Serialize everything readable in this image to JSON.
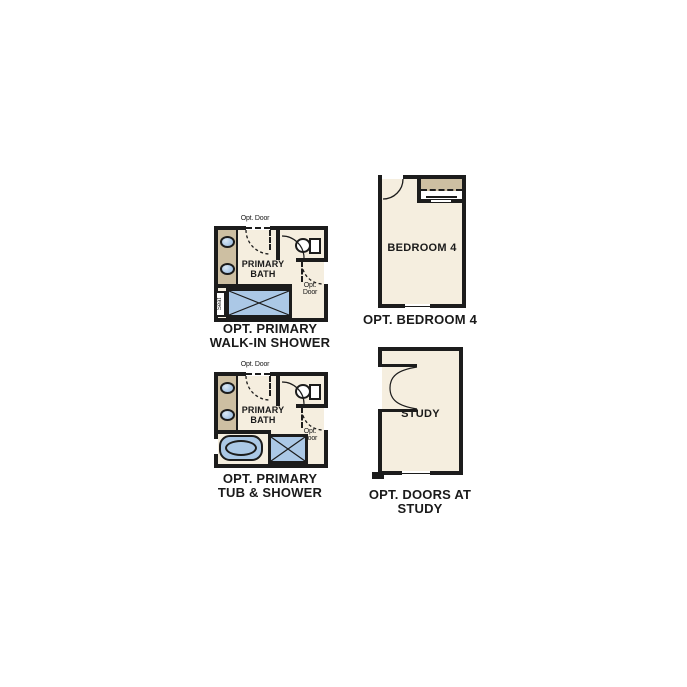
{
  "palette": {
    "wall": "#1c1c1c",
    "floor": "#f5eedf",
    "cabinet_tan": "#cdbfa2",
    "fixture_blue": "#abc8e6",
    "fixture_white": "#ffffff"
  },
  "plans": {
    "walk_in_shower": {
      "opt_door_top": "Opt. Door",
      "room_line1": "PRIMARY",
      "room_line2": "BATH",
      "opt_door_side_line1": "Opt.",
      "opt_door_side_line2": "Door",
      "seat": "Seat",
      "title_line1": "OPT. PRIMARY",
      "title_line2": "WALK-IN SHOWER"
    },
    "tub_shower": {
      "opt_door_top": "Opt. Door",
      "room_line1": "PRIMARY",
      "room_line2": "BATH",
      "opt_door_side_line1": "Opt.",
      "opt_door_side_line2": "Door",
      "title_line1": "OPT. PRIMARY",
      "title_line2": "TUB & SHOWER"
    },
    "bedroom_4": {
      "room": "BEDROOM 4",
      "title": "OPT. BEDROOM 4"
    },
    "study": {
      "room": "STUDY",
      "title_line1": "OPT. DOORS AT",
      "title_line2": "STUDY"
    }
  }
}
